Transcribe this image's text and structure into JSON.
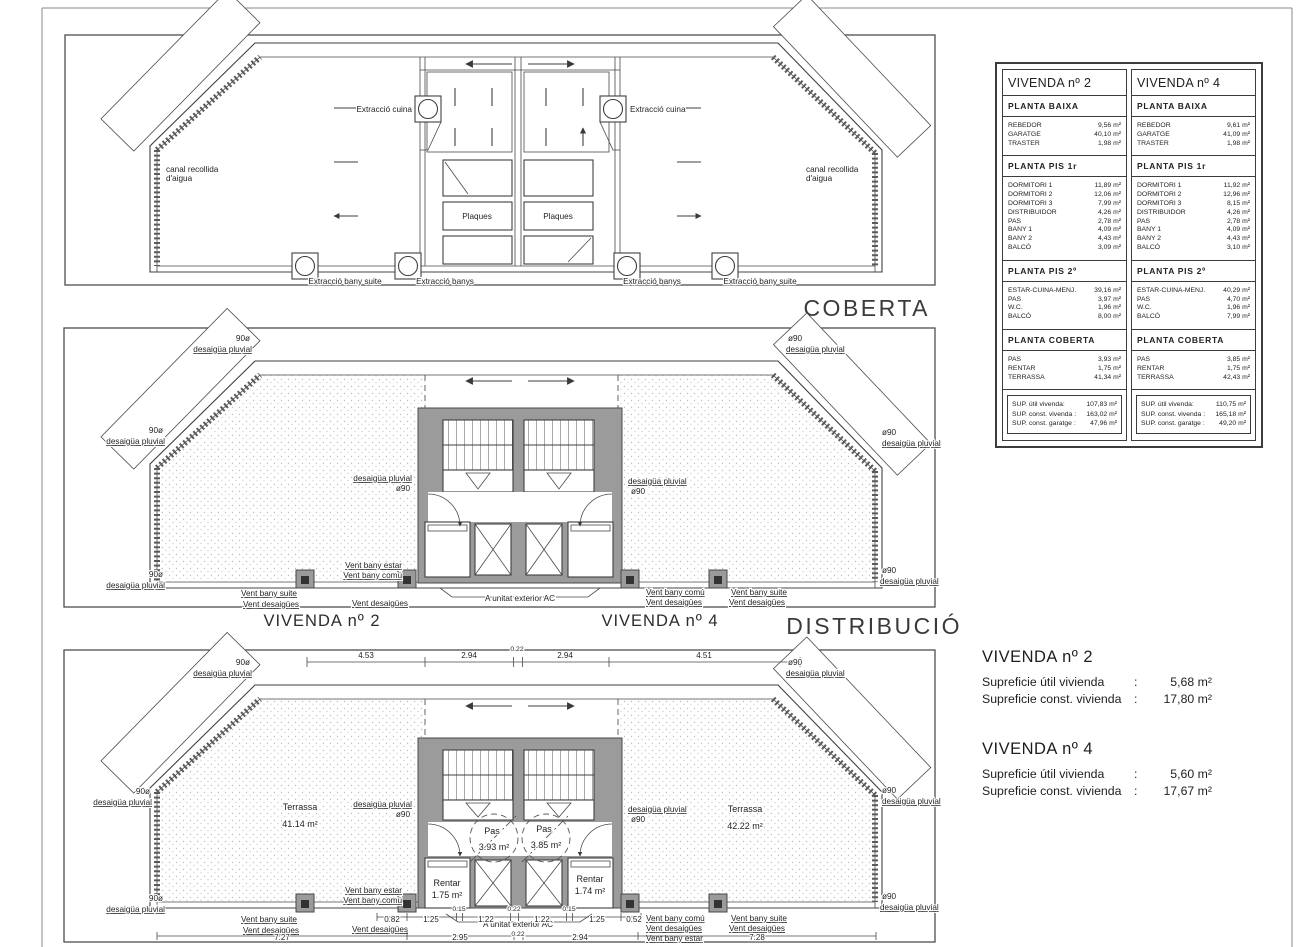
{
  "colors": {
    "line": "#3f3f3f",
    "wall": "#9b9b9b"
  },
  "labels": {
    "desaigua_pluvial": "desaigüa pluvial",
    "o90": "ø90",
    "n90": "90ø",
    "vent_bany_estar": "Vent bany estar",
    "vent_bany_comu": "Vent bany comú",
    "vent_bany_suite": "Vent bany suite",
    "vent_desaigues": "Vent desaigües",
    "a_unitat": "A unitat exterior AC",
    "canal_line1": "canal recollida",
    "canal_line2": "d'aigua",
    "extraccio_cuina": "Extracció cuina",
    "extraccio_banys": "Extracció banys",
    "extraccio_bany_suite": "Extracció bany suite",
    "plaques": "Plaques"
  },
  "coberta": {
    "title": "COBERTA"
  },
  "distribucio": {
    "title": "DISTRIBUCIÓ",
    "vivenda2": "VIVENDA nº 2",
    "vivenda4": "VIVENDA nº 4"
  },
  "planta": {
    "dims_top": [
      "4.53",
      "2.94",
      "0.22",
      "2.94",
      "4.51"
    ],
    "dims_mid": [
      "0.82",
      "1.25",
      "0.15",
      "1.22",
      "0.22",
      "1.22",
      "0.15",
      "1.25",
      "0.52"
    ],
    "dims_bottom": [
      "7.27",
      "2.95",
      "0.22",
      "2.94",
      "7.28"
    ],
    "terrassa_left": {
      "name": "Terrassa",
      "area": "41.14 m²"
    },
    "terrassa_right": {
      "name": "Terrassa",
      "area": "42.22 m²"
    },
    "pas_left": {
      "name": "Pas",
      "area": "3.93 m²"
    },
    "pas_right": {
      "name": "Pas",
      "area": "3.85 m²"
    },
    "rentar_left": {
      "name": "Rentar",
      "area": "1.75 m²"
    },
    "rentar_right": {
      "name": "Rentar",
      "area": "1.74 m²"
    }
  },
  "table": {
    "columns": [
      {
        "title": "VIVENDA nº 2",
        "sections": [
          {
            "header": "PLANTA BAIXA",
            "rows": [
              [
                "REBEDOR",
                "9,56 m²"
              ],
              [
                "GARATGE",
                "40,10 m²"
              ],
              [
                "TRASTER",
                "1,98 m²"
              ]
            ]
          },
          {
            "header": "PLANTA PIS 1r",
            "rows": [
              [
                "DORMITORI 1",
                "11,89 m²"
              ],
              [
                "DORMITORI 2",
                "12,06 m²"
              ],
              [
                "DORMITORI 3",
                "7,99 m²"
              ],
              [
                "DISTRIBUIDOR",
                "4,26 m²"
              ],
              [
                "PAS",
                "2,78 m²"
              ],
              [
                "BANY 1",
                "4,09 m²"
              ],
              [
                "BANY 2",
                "4,43 m²"
              ],
              [
                "BALCÓ",
                "3,09 m²"
              ]
            ]
          },
          {
            "header": "PLANTA PIS 2º",
            "rows": [
              [
                "ESTAR-CUINA-MENJ.",
                "39,16 m²"
              ],
              [
                "PAS",
                "3,97 m²"
              ],
              [
                "W.C.",
                "1,96 m²"
              ],
              [
                "BALCÓ",
                "8,00 m²"
              ]
            ]
          },
          {
            "header": "PLANTA COBERTA",
            "rows": [
              [
                "PAS",
                "3,93 m²"
              ],
              [
                "RENTAR",
                "1,75 m²"
              ],
              [
                "TERRASSA",
                "41,34 m²"
              ]
            ]
          }
        ],
        "summary": [
          [
            "SUP. útil vivenda:",
            "107,83 m²"
          ],
          [
            "SUP. const. vivenda :",
            "163,02 m²"
          ],
          [
            "SUP. const. garatge :",
            "47,96 m²"
          ]
        ]
      },
      {
        "title": "VIVENDA nº 4",
        "sections": [
          {
            "header": "PLANTA BAIXA",
            "rows": [
              [
                "REBEDOR",
                "9,61 m²"
              ],
              [
                "GARATGE",
                "41,09 m²"
              ],
              [
                "TRASTER",
                "1,98 m²"
              ]
            ]
          },
          {
            "header": "PLANTA PIS 1r",
            "rows": [
              [
                "DORMITORI 1",
                "11,92 m²"
              ],
              [
                "DORMITORI 2",
                "12,96 m²"
              ],
              [
                "DORMITORI 3",
                "8,15 m²"
              ],
              [
                "DISTRIBUIDOR",
                "4,26 m²"
              ],
              [
                "PAS",
                "2,78 m²"
              ],
              [
                "BANY 1",
                "4,09 m²"
              ],
              [
                "BANY 2",
                "4,43 m²"
              ],
              [
                "BALCÓ",
                "3,10 m²"
              ]
            ]
          },
          {
            "header": "PLANTA PIS 2º",
            "rows": [
              [
                "ESTAR-CUINA-MENJ.",
                "40,29 m²"
              ],
              [
                "PAS",
                "4,70 m²"
              ],
              [
                "W.C.",
                "1,96 m²"
              ],
              [
                "BALCÓ",
                "7,99 m²"
              ]
            ]
          },
          {
            "header": "PLANTA COBERTA",
            "rows": [
              [
                "PAS",
                "3,85 m²"
              ],
              [
                "RENTAR",
                "1,75 m²"
              ],
              [
                "TERRASSA",
                "42,43 m²"
              ]
            ]
          }
        ],
        "summary": [
          [
            "SUP. útil vivenda:",
            "110,75 m²"
          ],
          [
            "SUP. const. vivenda :",
            "165,18 m²"
          ],
          [
            "SUP. const. garatge :",
            "49,20 m²"
          ]
        ]
      }
    ]
  },
  "summaries": [
    {
      "title": "VIVENDA nº 2",
      "rows": [
        {
          "label": "Supreficie útil vivienda",
          "sep": ":",
          "value": "5,68 m²"
        },
        {
          "label": "Supreficie const. vivienda",
          "sep": ":",
          "value": "17,80 m²"
        }
      ]
    },
    {
      "title": "VIVENDA nº 4",
      "rows": [
        {
          "label": "Supreficie útil vivienda",
          "sep": ":",
          "value": "5,60 m²"
        },
        {
          "label": "Supreficie const. vivienda",
          "sep": ":",
          "value": "17,67 m²"
        }
      ]
    }
  ]
}
